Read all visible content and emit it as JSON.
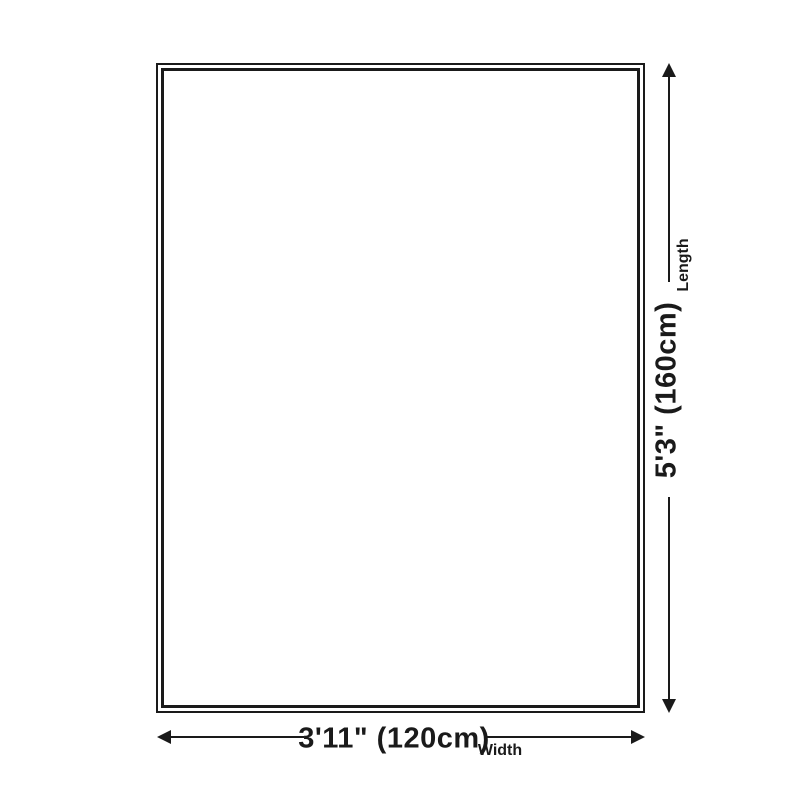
{
  "diagram": {
    "background_color": "#ffffff",
    "line_color": "#1a1a1a",
    "product_outline": {
      "shape": "rectangle",
      "border_style": "double"
    },
    "length": {
      "value": "5'3\" (160cm)",
      "label": "Length"
    },
    "width": {
      "value": "3'11\" (120cm)",
      "label": "Width"
    }
  }
}
